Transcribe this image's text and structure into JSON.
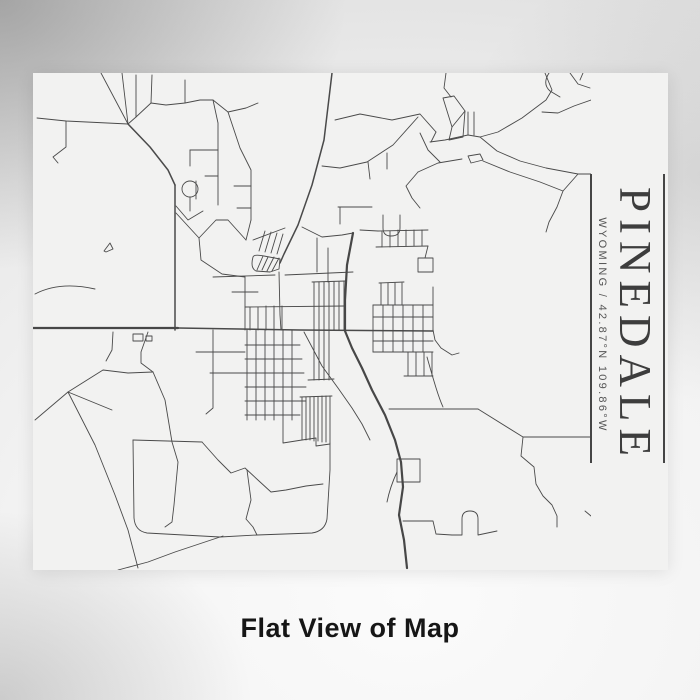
{
  "poster": {
    "title": "PINEDALE",
    "subtitle": "WYOMING / 42.87°N 109.86°W",
    "place": "Pinedale",
    "state": "Wyoming",
    "coordinates": "42.87°N 109.86°W"
  },
  "caption": "Flat View of Map",
  "colors": {
    "poster_bg": "#f2f2f1",
    "street": "#4a4a4a",
    "title_text": "#3d3d3d",
    "subtitle_text": "#565656",
    "rule": "#454545",
    "caption_text": "#161616"
  },
  "map": {
    "type": "street-map",
    "view": "flat",
    "roundabouts": [
      {
        "cx": 190,
        "cy": 189,
        "r": 8
      }
    ],
    "roads": {
      "major": [
        "M33,328 L178,328",
        "M353,233 L347,265 L345,300 L345,331 L352,348 L362,368 L372,390 L385,415 L395,440 L401,462 L403,487 L399,515 L404,540 L407,568"
      ],
      "medium": [
        "M178,328 L300,330 L433,331",
        "M332,73 L324,140 L312,185 L298,225 L284,254 L280,263",
        "M128,124 L150,147 L168,170 L175,185",
        "M175,185 L175,330"
      ],
      "minor": [
        "M37,118 L66,121 L128,124",
        "M66,121 L66,147 L53,157 L58,163",
        "M101,73 L128,124",
        "M122,73 L128,124",
        "M128,124 L136,117 L136,75",
        "M136,117 L151,103 L166,105 L185,103 L200,100 L213,100 L228,112 L246,108 L258,103",
        "M151,103 L152,75",
        "M185,103 L185,80",
        "M213,100 L218,123 L218,205",
        "M190,150 L218,150",
        "M190,150 L190,166",
        "M205,176 L218,176",
        "M196,181 L196,199",
        "M228,112 L240,148 L251,170 L251,220",
        "M234,186 L251,186",
        "M237,208 L251,208",
        "M190,197 L190,211",
        "M176,206 L188,220 L203,211",
        "M176,213 L199,238 L216,220 L228,220 L246,240",
        "M199,238 L201,260 L222,274 L245,277",
        "M251,220 L246,240",
        "M35,294 Q60,281 95,289",
        "M104,251 L110,243 L113,249 L106,252 Z",
        "M113,332 L112,350 L106,361",
        "M148,332 L141,352 L141,363 L153,372",
        "M153,372 L165,400 L172,442 L178,462 L174,505 L172,522 L165,527",
        "M35,420 L68,392 L103,370 L128,373 L153,372",
        "M68,392 L95,445 L115,495 L128,530 L138,568",
        "M68,392 L112,410",
        "M133,334 L143,334 L143,341 L133,341 Z",
        "M146,336 L152,336 L152,341 L146,341 Z",
        "M245,277 L245,330",
        "M232,292 L258,292",
        "M213,277 L275,275",
        "M245,307 L345,306",
        "M250,307 L250,330",
        "M258,307 L258,330",
        "M266,306 L266,330",
        "M274,306 L274,330",
        "M282,306 L282,330",
        "M247,330 L247,420",
        "M256,330 L256,420",
        "M265,330 L265,420",
        "M274,330 L274,420",
        "M283,330 L283,443 L302,440",
        "M292,330 L292,420",
        "M245,345 L300,345",
        "M245,359 L302,359",
        "M245,373 L304,373",
        "M245,387 L306,387",
        "M245,401 L306,401",
        "M245,415 L300,415",
        "M213,330 L213,408 L206,414",
        "M196,352 L245,352",
        "M210,373 L245,373",
        "M302,397 L302,440",
        "M306,397 L306,440",
        "M310,397 L310,440",
        "M314,397 L314,441",
        "M318,397 L318,441",
        "M322,396 L322,442",
        "M326,396 L326,442",
        "M330,396 L330,443",
        "M302,440 L316,438 L316,446 L330,444",
        "M300,397 L332,396",
        "M253,257 Q250,268 256,271 L270,272 L279,269 L280,259 L264,256 Q254,254 253,257",
        "M257,270 L263,256",
        "M262,270 L268,257",
        "M267,271 L274,257",
        "M272,271 L279,258",
        "M253,240 L285,228",
        "M259,251 L265,231",
        "M265,252 L271,232",
        "M271,253 L277,233",
        "M277,254 L283,234",
        "M279,272 L280,315 L281,330",
        "M285,275 L353,272",
        "M302,227 L322,237 L342,235 L353,233",
        "M317,238 L317,272",
        "M328,248 L328,282",
        "M312,282 L346,281",
        "M314,282 L314,330",
        "M319,282 L319,330",
        "M324,282 L324,330",
        "M329,282 L329,330",
        "M334,282 L334,330",
        "M339,282 L339,330",
        "M344,281 L344,330",
        "M314,330 L314,380",
        "M319,330 L319,380",
        "M324,330 L324,380",
        "M329,330 L329,380",
        "M308,380 L334,379",
        "M379,283 L404,282",
        "M381,283 L381,305",
        "M388,283 L388,305",
        "M395,283 L395,305",
        "M402,283 L402,305",
        "M373,305 L433,305",
        "M373,317 L433,317",
        "M373,341 L433,341",
        "M373,352 L433,352",
        "M373,305 L373,352",
        "M383,305 L383,352",
        "M393,305 L393,352",
        "M403,305 L403,352",
        "M413,305 L413,352",
        "M423,305 L423,352",
        "M433,287 L433,330",
        "M408,352 L408,376",
        "M416,352 L416,376",
        "M424,352 L424,376",
        "M432,352 L432,376",
        "M404,376 L433,376",
        "M418,258 L433,258 L433,272 L418,272 Z",
        "M433,330 L435,340 L441,348 L452,355 L459,353",
        "M376,247 L428,246",
        "M378,231 L428,230",
        "M382,231 L382,247",
        "M390,231 L390,247",
        "M398,230 L398,246",
        "M406,230 L406,246",
        "M414,230 L414,246",
        "M422,230 L422,246",
        "M428,246 L425,258",
        "M360,230 L378,231",
        "M389,409 L478,409",
        "M478,409 L523,437",
        "M523,437 L590,437",
        "M523,437 L521,456 L534,467 L536,484 L543,496 L552,505 L557,516 L557,527",
        "M427,357 C433,378 438,396 443,407",
        "M397,459 L420,459 L420,482 L397,482 Z",
        "M397,472 Q390,487 387,502",
        "M403,521 L433,521 L436,534 L452,535",
        "M452,535 L462,535 L462,519 Q462,511 470,511 Q478,511 478,519 L478,535 L497,531",
        "M585,511 L591,516",
        "M133,440 L202,442",
        "M133,440 L134,518 Q135,531 147,533 L220,537 L257,535 L312,533 Q325,531 327,519 L330,470 L330,443",
        "M202,442 L218,460 L231,473 L245,468 L259,481 L271,492 L286,490 L306,486 L323,484",
        "M247,470 L251,500 L246,519 L253,527 L257,535",
        "M223,536 L175,552 L148,562 L118,570",
        "M335,120 L360,114 L392,120 L420,114 L436,132",
        "M418,117 L393,145 L367,162 L340,168 L322,166",
        "M368,162 L370,179",
        "M387,153 L387,169",
        "M436,132 L431,142",
        "M338,207 L372,207",
        "M340,207 L340,224",
        "M383,215 L383,228 Q383,236 391,236 Q400,236 400,228 L400,215",
        "M418,172 L406,186 L412,198 L420,208",
        "M446,73 L444,88 L451,97",
        "M443,98 L452,127 L465,111 L454,96 Z",
        "M452,127 L449,140 L463,137 L465,111",
        "M468,112 L468,135",
        "M474,112 L474,135",
        "M430,142 L445,140 L468,135 L480,137",
        "M545,73 L552,90 L546,100 L522,118 L498,132 L480,137",
        "M591,100 L574,106 L558,113 L542,112",
        "M480,137 L497,151 L520,161 L546,168 L578,174 L591,174",
        "M578,174 L563,191 L557,207 L549,222 L546,232",
        "M418,172 L438,163 L462,159",
        "M468,156 L480,154 L483,160 L471,163 Z",
        "M483,161 L510,172 L540,182 L563,191",
        "M549,73 Q542,84 550,91 L560,97",
        "M570,73 L578,84 L590,88",
        "M583,73 L580,80",
        "M420,133 L428,150 L440,162",
        "M304,332 L322,366 L338,388 L352,408 L362,424 L370,440"
      ]
    }
  }
}
